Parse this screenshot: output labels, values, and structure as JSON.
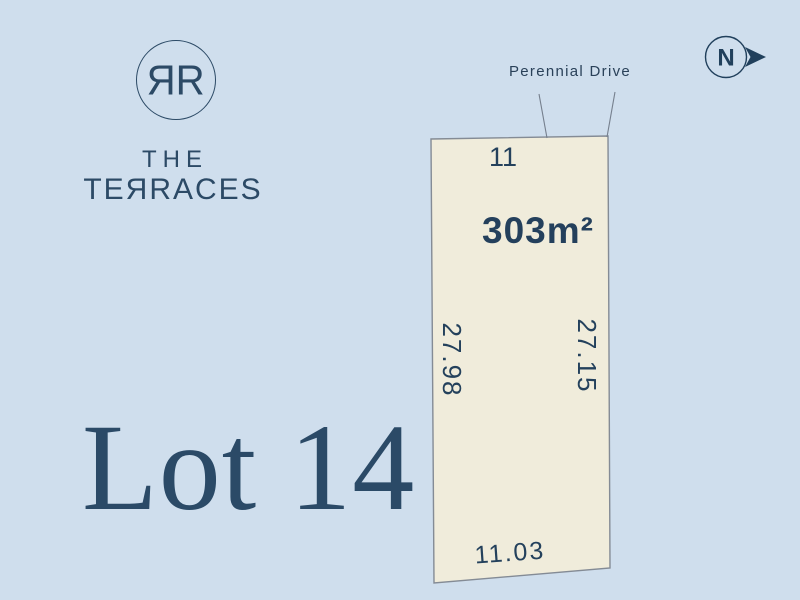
{
  "branding": {
    "monogram": "ЯR",
    "name_line1": "THE",
    "name_line2": "TEЯRACES"
  },
  "lot": {
    "title": "Lot 14",
    "street_number": "11",
    "area": "303m²",
    "street_name": "Perennial Drive",
    "dimensions": {
      "left_boundary": "27.98",
      "right_boundary": "27.15",
      "bottom_boundary": "11.03"
    }
  },
  "compass": {
    "label": "N",
    "direction": "right"
  },
  "colors": {
    "background": "#cfdeed",
    "lot_fill": "#f0ecdb",
    "lot_border": "#848b95",
    "navy_text": "#21405c"
  }
}
